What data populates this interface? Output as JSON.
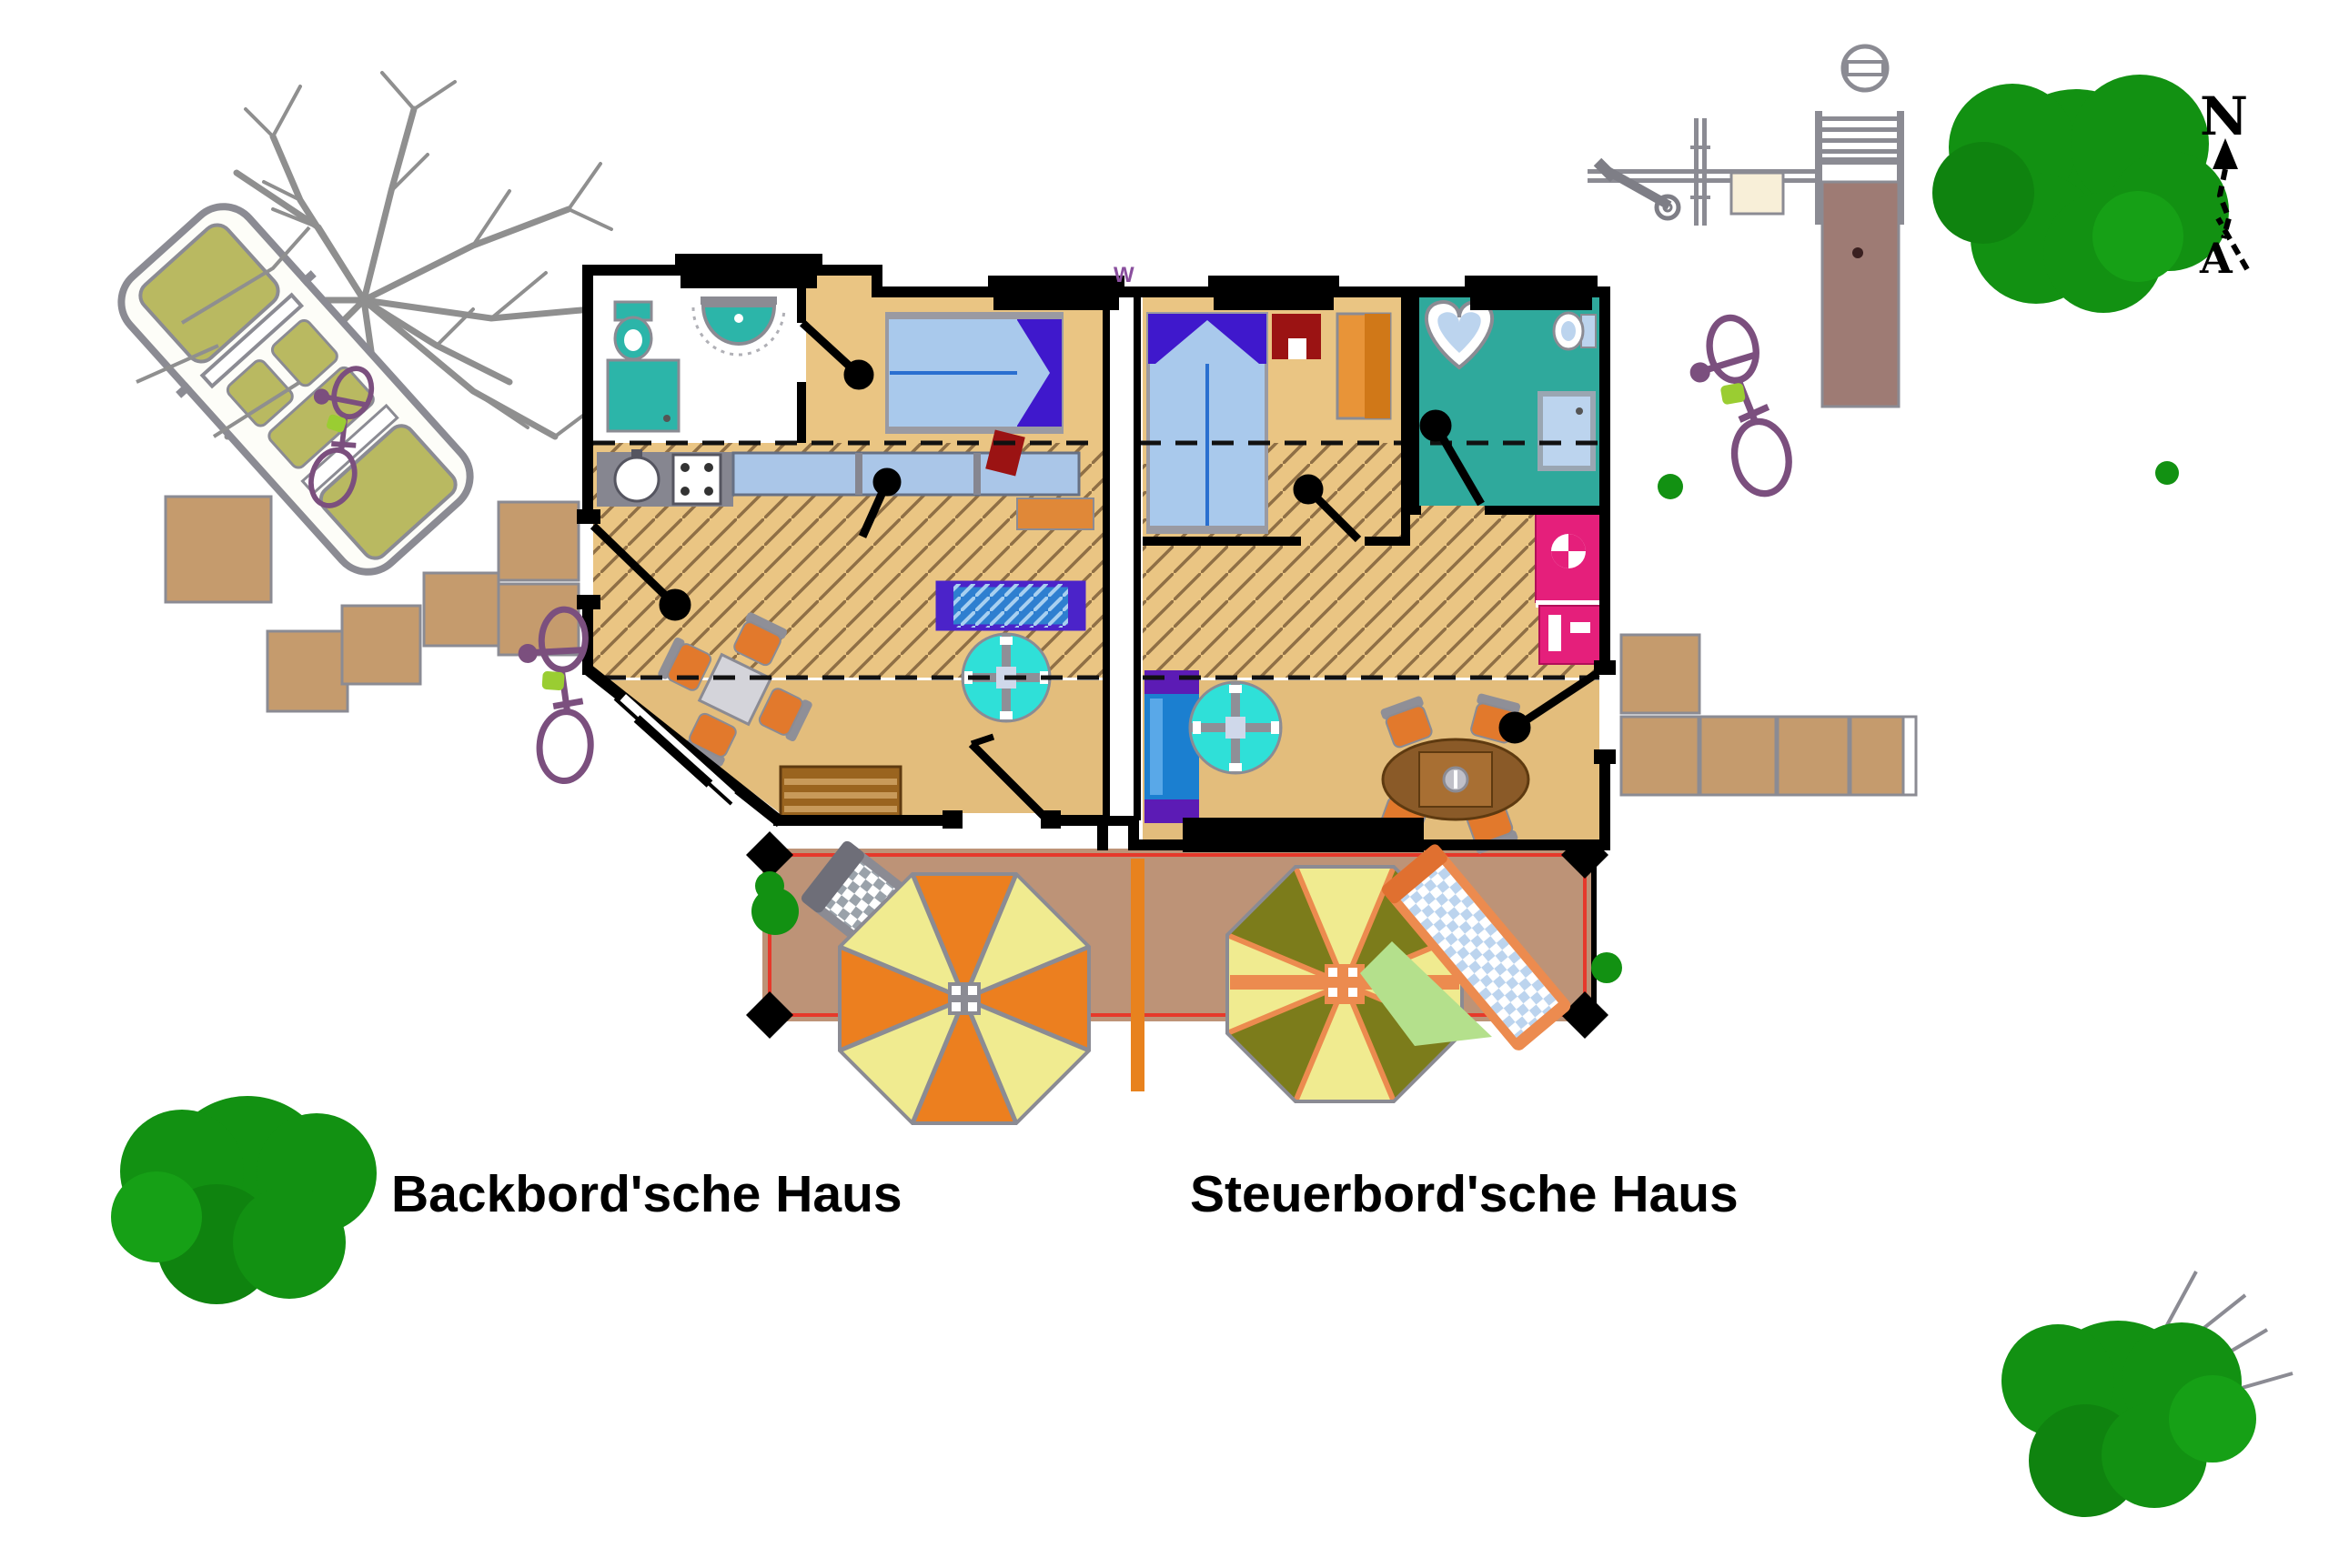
{
  "labels": {
    "left_house": "Backbord'sche Haus",
    "right_house": "Steuerbord'sche Haus"
  },
  "compass": {
    "north_letter": "N",
    "tail_letter": "A"
  },
  "house": {
    "wall_mark": "W"
  },
  "colors": {
    "wall_black": "#000000",
    "floor_hatched_tan": "#eac583",
    "floor_plain_tan": "#e3bd7c",
    "hatch_line_brown": "#8f6f45",
    "terrace_brown": "#bd9377",
    "boundary_red": "#e6392b",
    "divider_orange": "#e8821e",
    "bathroom_teal_floor": "#2fa99c",
    "fixture_teal": "#2cb5a9",
    "bed_blue": "#a9c9ec",
    "canopy_purple": "#3f18cc",
    "sofa_blue": "#1b7fd0",
    "sofa_purple": "#5c1bb5",
    "glass_table_teal": "#2fe0d8",
    "chair_orange": "#e2792c",
    "wood_brown": "#9a641f",
    "wardrobe_magenta": "#e51f7b",
    "umbrella_orange": "#ec7f1f",
    "umbrella_yellow": "#f0eb90",
    "umbrella_olive": "#7c7c1b",
    "lounger_gray": "#8b8b93",
    "tree_green": "#129112",
    "stone_tan": "#c59b6d",
    "car_olive": "#b9b961",
    "bike_purple": "#7b4f7e",
    "metal_gray": "#8b8b93",
    "sign_cream": "#f8efd8",
    "path_mauve": "#9e7b74"
  }
}
